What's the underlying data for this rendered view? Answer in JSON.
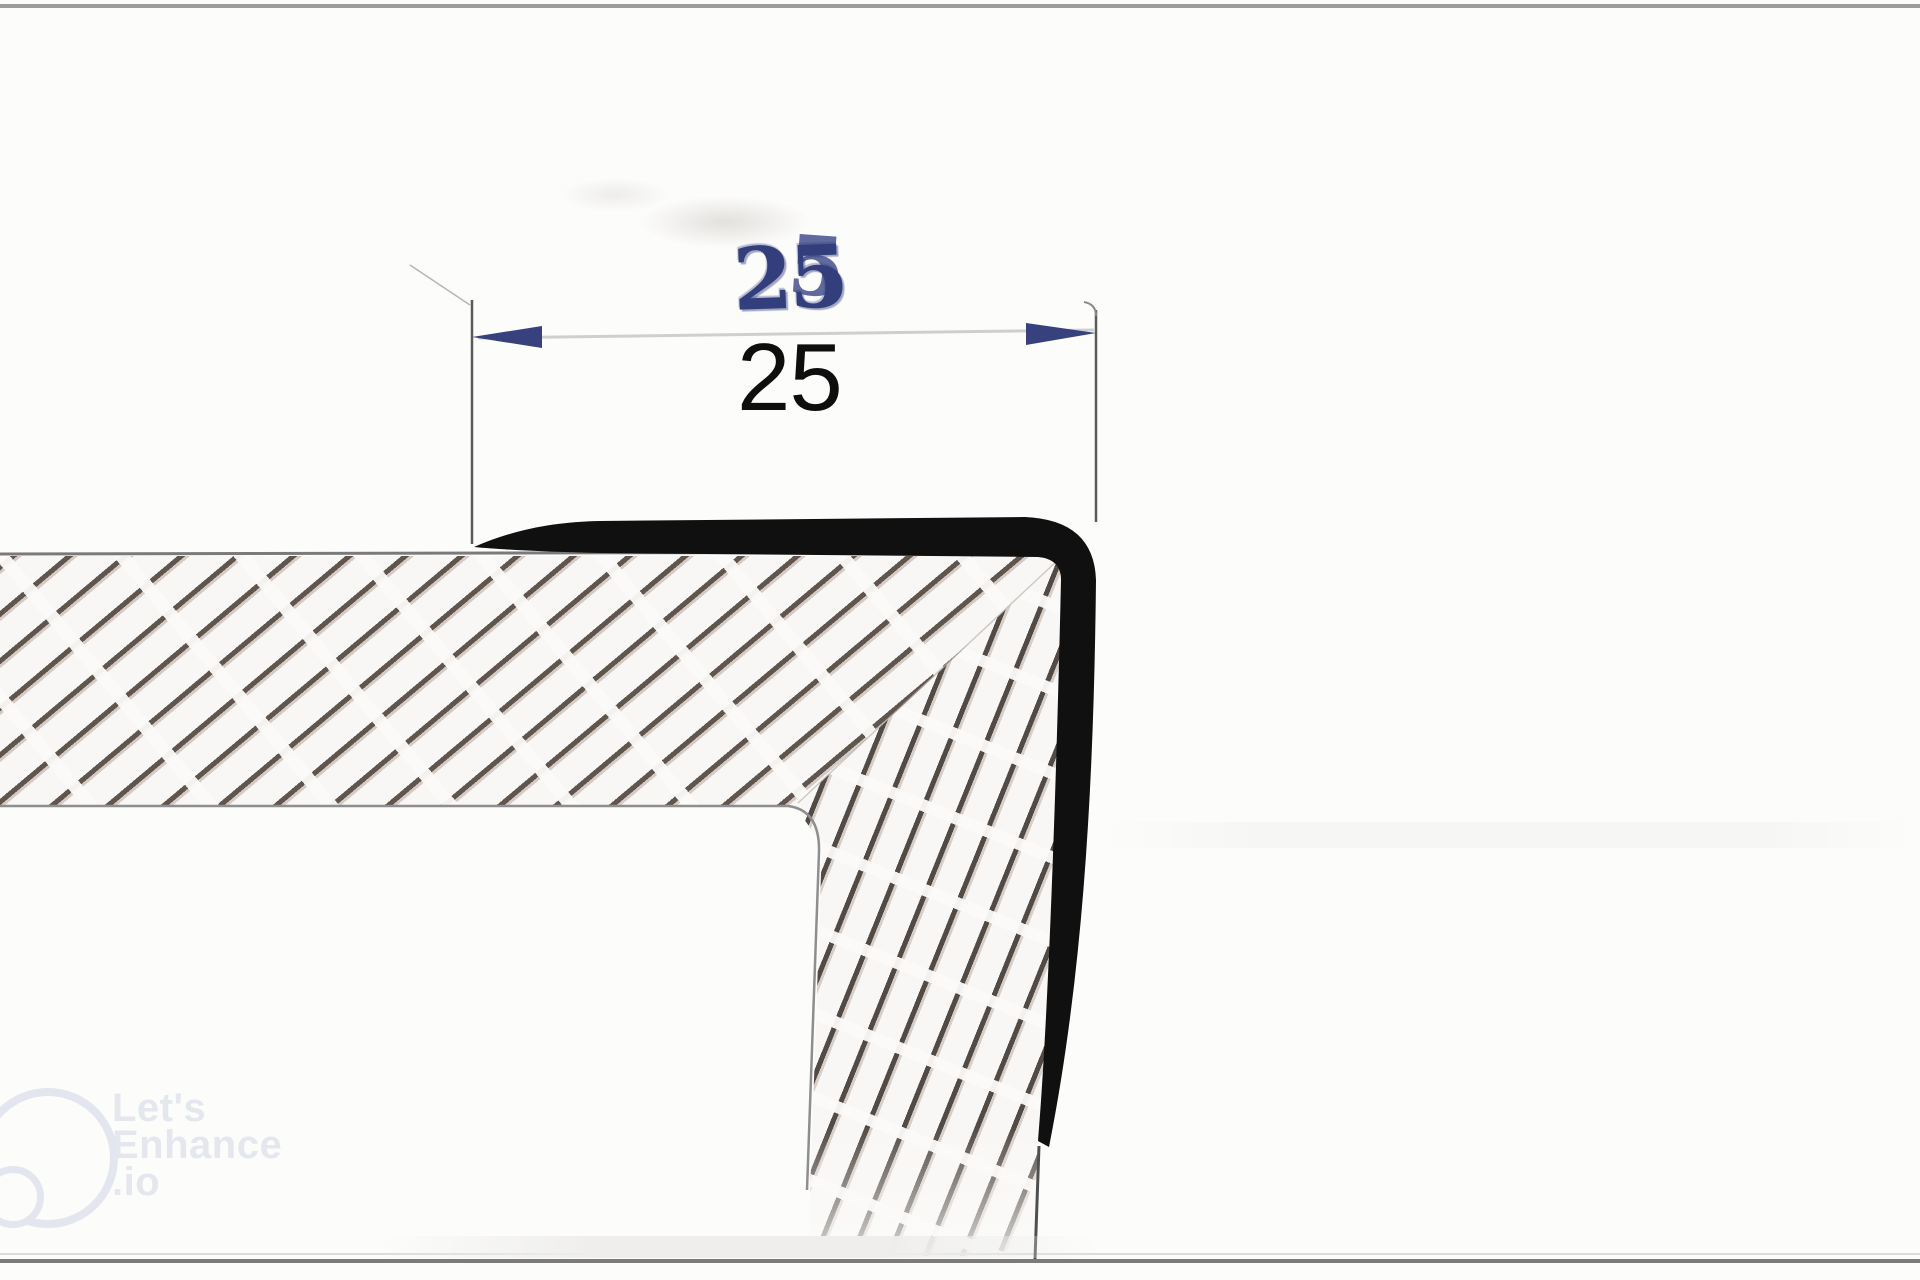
{
  "drawing": {
    "kind": "technical cross-section detail of an L-shaped edge trim profile on a hatched slab and column",
    "dimension": {
      "printed_value": "25",
      "handwritten_value": "25",
      "overstrike_glyph": "5"
    },
    "colors": {
      "background": "#fcfcfb",
      "profile_black": "#101010",
      "dimension_blue": "#36417e",
      "handwritten_ink_blue": "#333f7d",
      "printed_text_black": "#0e0e0e",
      "hatch_stroke_dark": "#4a3f37",
      "hatch_stroke_brown": "#816252",
      "edge_line_gray": "#7d7d7d",
      "dimension_line_gray": "#cfcfcf",
      "watermark_gray": "#e3e6ee"
    }
  },
  "watermark": {
    "line1": "Let's",
    "line2": "Enhance",
    "line3": ".io"
  }
}
